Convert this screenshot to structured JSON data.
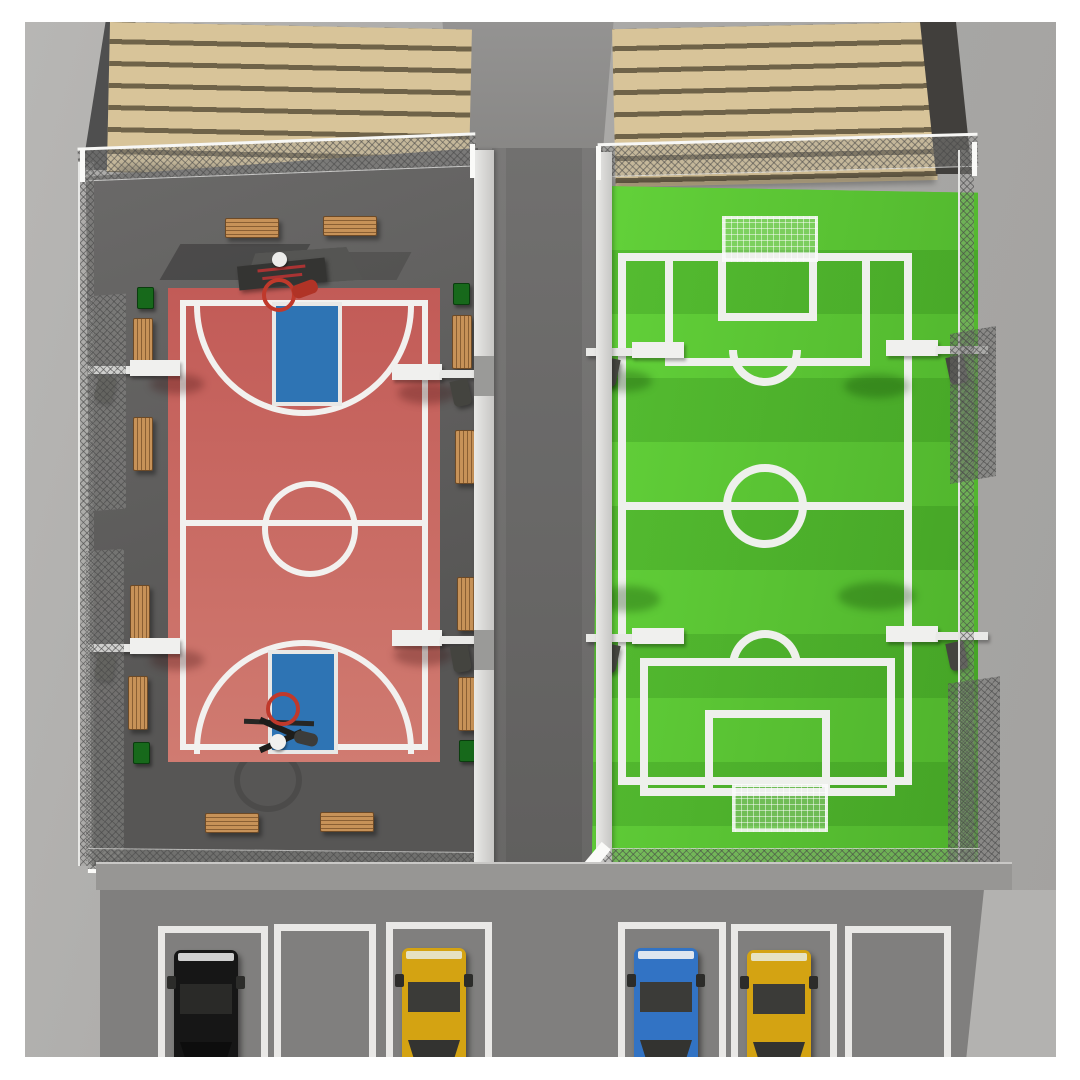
{
  "scene": {
    "name": "Outdoor sports complex — aerial 3D render",
    "description": "Top-down 3D render: red basketball court (left) and striped green mini soccer pitch (right) in chain-link enclosures between tan slatted buildings, with floodlights, wooden benches, green bins, and a six-space parking lot with four cars at the bottom.",
    "buildings": {
      "count": 2,
      "style": "tan horizontal-slat roofs",
      "positions": [
        "top-left",
        "top-right"
      ]
    },
    "basketball_area": {
      "surface_color_name": "red",
      "key_color_name": "blue",
      "hoops": 2,
      "benches": 12,
      "bins": 4,
      "floodlights": 4,
      "markings": [
        "boundary",
        "halfway line",
        "center circle",
        "two blue keys",
        "two three-point arcs"
      ]
    },
    "soccer_area": {
      "surface_color_name": "green with mowing stripes",
      "goals": 2,
      "floodlights": 4,
      "markings": [
        "touchlines",
        "goal lines",
        "halfway line",
        "center circle",
        "two penalty areas",
        "two goal areas",
        "two penalty arcs"
      ]
    },
    "parking": {
      "spaces": 6,
      "occupied": 4,
      "empty_spaces": 2,
      "cars": [
        {
          "slot": 1,
          "color_name": "black"
        },
        {
          "slot": 3,
          "color_name": "yellow"
        },
        {
          "slot": 4,
          "color_name": "blue"
        },
        {
          "slot": 5,
          "color_name": "yellow"
        }
      ]
    }
  },
  "colors": {
    "page_bg": "#ffffff",
    "ground_light": "#aeadab",
    "court_apron": "#5d5c5b",
    "center_path": "#6d6c6b",
    "parking_asphalt": "#807f7e",
    "building_tan": "#d8c499",
    "building_slat_gap": "#6f6349",
    "court_red": "#c9655f",
    "key_blue": "#2e74b4",
    "line_white": "#f1f0ee",
    "field_green": "#58c532",
    "field_stripe_green": "#4ea72e",
    "fence_rail": "#f5f5f3",
    "bench_wood": "#bd8b50",
    "bin_green": "#17691b",
    "car_black": "#161616",
    "car_yellow": "#d4a312",
    "car_blue": "#3273c4",
    "hoop_red": "#c0392b",
    "lamp_white": "#ebebe9",
    "lamp_head_gray": "#44443f"
  }
}
